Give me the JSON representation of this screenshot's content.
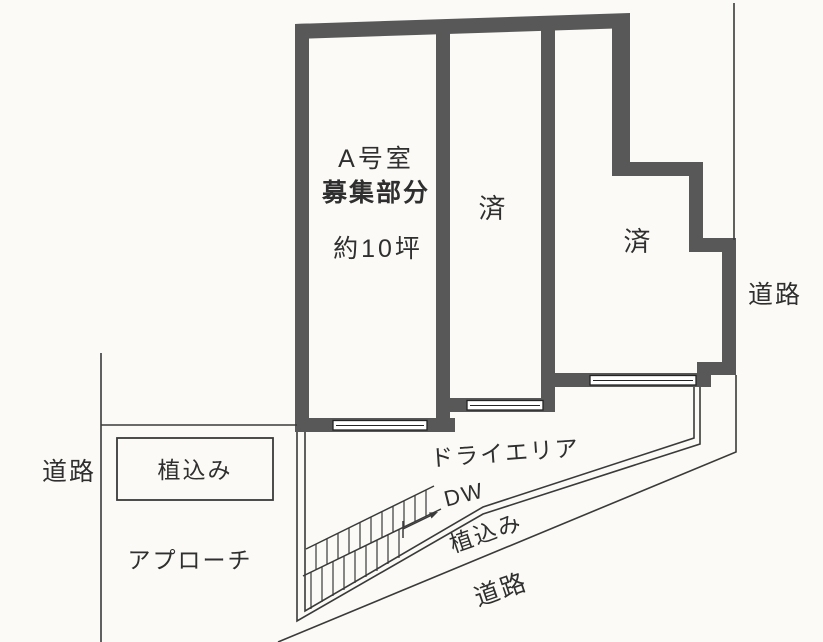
{
  "plan": {
    "rooms": {
      "room_a": {
        "name_line": "A号室",
        "recruit_line": "募集部分",
        "size_line": "約10坪"
      },
      "room_b": {
        "status": "済"
      },
      "room_c": {
        "status": "済"
      }
    },
    "areas": {
      "dry_area_label": "ドライエリア",
      "dw_label": "DW",
      "planting_strip_label": "植込み",
      "planting_box_label": "植込み",
      "approach_label": "アプローチ"
    },
    "roads": {
      "right_label": "道路",
      "left_label": "道路",
      "bottom_label": "道路"
    },
    "colors": {
      "wall": "#585858",
      "thin_line": "#3a3a3a",
      "text": "#2f2f2f",
      "background": "#fbfaf6",
      "window_fill": "#ffffff"
    }
  }
}
